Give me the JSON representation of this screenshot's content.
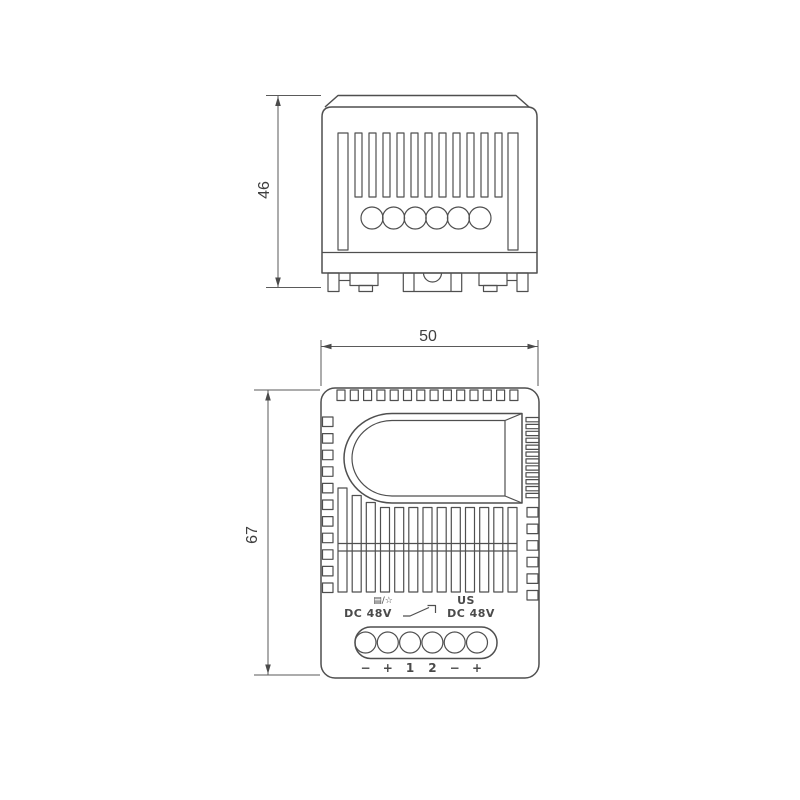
{
  "drawing": {
    "dimensions": {
      "side_height": "46",
      "front_width": "50",
      "front_height": "67"
    },
    "front_markings": {
      "function_symbol": "▤/☆",
      "supply_label": "US",
      "voltage_left": "DC 48V",
      "voltage_right": "DC 48V"
    },
    "terminal_labels": [
      "−",
      "+",
      "1",
      "2",
      "−",
      "+"
    ],
    "colors": {
      "line": "#4f4f4f",
      "text": "#3f3f3f",
      "background": "#ffffff"
    }
  }
}
